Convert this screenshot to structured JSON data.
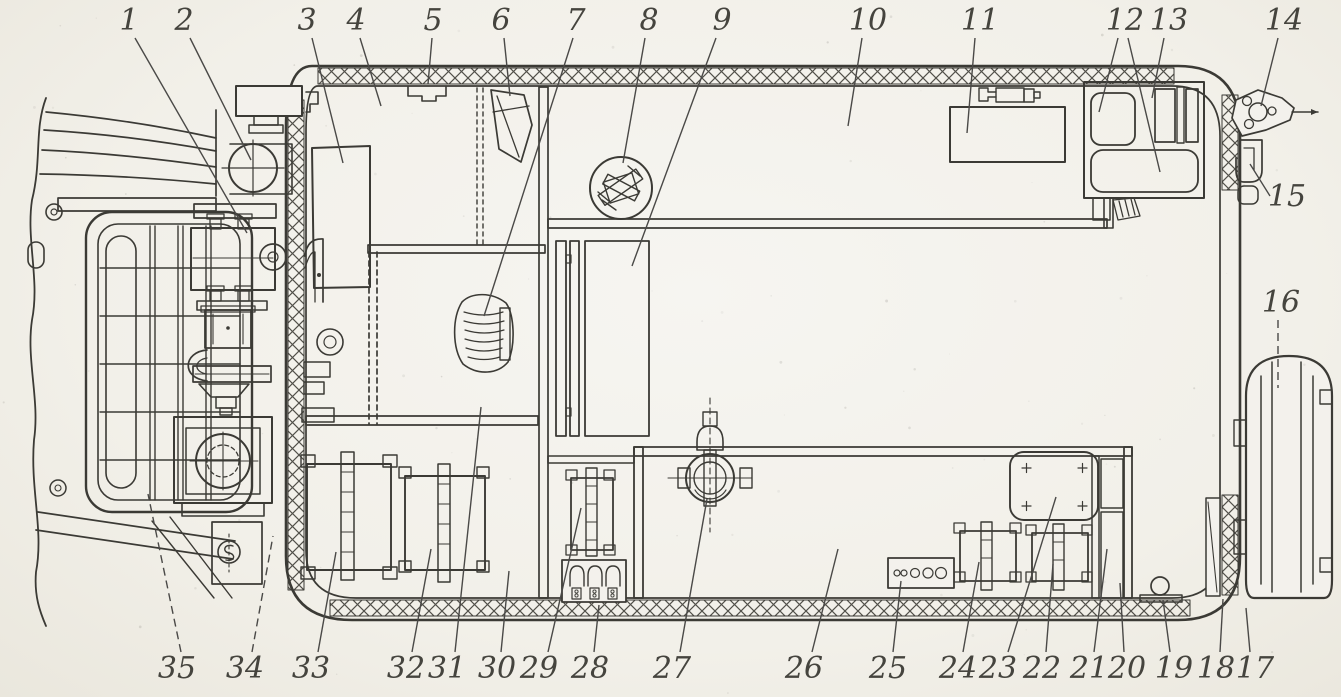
{
  "meta": {
    "type": "scanned technical cutaway diagram",
    "subject": "top-view schematic of vehicle body with numbered equipment layout",
    "numbered_parts_count": 35
  },
  "palette": {
    "paper": "#f3f1ec",
    "ink": "#3b3a35",
    "label_ink": "#45443e"
  },
  "callouts": [
    {
      "n": "1",
      "x": 129,
      "y": 30,
      "leaders": [
        {
          "x1": 135,
          "y1": 38,
          "x2": 247,
          "y2": 233
        }
      ]
    },
    {
      "n": "2",
      "x": 184,
      "y": 30,
      "leaders": [
        {
          "x1": 190,
          "y1": 38,
          "x2": 251,
          "y2": 160
        }
      ]
    },
    {
      "n": "3",
      "x": 307,
      "y": 30,
      "leaders": [
        {
          "x1": 312,
          "y1": 38,
          "x2": 343,
          "y2": 163
        }
      ]
    },
    {
      "n": "4",
      "x": 356,
      "y": 30,
      "leaders": [
        {
          "x1": 360,
          "y1": 38,
          "x2": 381,
          "y2": 106
        }
      ]
    },
    {
      "n": "5",
      "x": 433,
      "y": 30,
      "leaders": [
        {
          "x1": 432,
          "y1": 38,
          "x2": 428,
          "y2": 84
        }
      ]
    },
    {
      "n": "6",
      "x": 501,
      "y": 30,
      "leaders": [
        {
          "x1": 504,
          "y1": 38,
          "x2": 510,
          "y2": 96
        }
      ]
    },
    {
      "n": "7",
      "x": 576,
      "y": 30,
      "leaders": [
        {
          "x1": 573,
          "y1": 38,
          "x2": 484,
          "y2": 316
        }
      ]
    },
    {
      "n": "8",
      "x": 649,
      "y": 30,
      "leaders": [
        {
          "x1": 645,
          "y1": 38,
          "x2": 623,
          "y2": 163
        }
      ]
    },
    {
      "n": "9",
      "x": 722,
      "y": 30,
      "leaders": [
        {
          "x1": 716,
          "y1": 38,
          "x2": 632,
          "y2": 266
        }
      ]
    },
    {
      "n": "10",
      "x": 868,
      "y": 30,
      "leaders": [
        {
          "x1": 862,
          "y1": 38,
          "x2": 848,
          "y2": 126
        }
      ]
    },
    {
      "n": "11",
      "x": 980,
      "y": 30,
      "leaders": [
        {
          "x1": 975,
          "y1": 38,
          "x2": 967,
          "y2": 133
        }
      ]
    },
    {
      "n": "12",
      "x": 1125,
      "y": 30,
      "leaders": [
        {
          "x1": 1118,
          "y1": 38,
          "x2": 1099,
          "y2": 112
        },
        {
          "x1": 1128,
          "y1": 38,
          "x2": 1160,
          "y2": 172
        }
      ]
    },
    {
      "n": "13",
      "x": 1169,
      "y": 30,
      "leaders": [
        {
          "x1": 1164,
          "y1": 38,
          "x2": 1152,
          "y2": 98
        }
      ]
    },
    {
      "n": "14",
      "x": 1284,
      "y": 30,
      "leaders": [
        {
          "x1": 1278,
          "y1": 38,
          "x2": 1261,
          "y2": 106
        }
      ]
    },
    {
      "n": "15",
      "x": 1287,
      "y": 206,
      "leaders": [
        {
          "x1": 1270,
          "y1": 196,
          "x2": 1250,
          "y2": 164
        }
      ]
    },
    {
      "n": "16",
      "x": 1281,
      "y": 312,
      "leaders": [
        {
          "x1": 1278,
          "y1": 320,
          "x2": 1278,
          "y2": 388,
          "dash": true
        }
      ]
    },
    {
      "n": "17",
      "x": 1255,
      "y": 678,
      "leaders": [
        {
          "x1": 1250,
          "y1": 652,
          "x2": 1246,
          "y2": 608
        }
      ]
    },
    {
      "n": "18",
      "x": 1216,
      "y": 678,
      "leaders": [
        {
          "x1": 1220,
          "y1": 652,
          "x2": 1223,
          "y2": 599
        }
      ]
    },
    {
      "n": "19",
      "x": 1174,
      "y": 678,
      "leaders": [
        {
          "x1": 1170,
          "y1": 652,
          "x2": 1163,
          "y2": 600
        }
      ]
    },
    {
      "n": "20",
      "x": 1127,
      "y": 678,
      "leaders": [
        {
          "x1": 1124,
          "y1": 652,
          "x2": 1120,
          "y2": 583
        }
      ]
    },
    {
      "n": "21",
      "x": 1089,
      "y": 678,
      "leaders": [
        {
          "x1": 1094,
          "y1": 652,
          "x2": 1107,
          "y2": 549
        }
      ]
    },
    {
      "n": "22",
      "x": 1042,
      "y": 678,
      "leaders": [
        {
          "x1": 1046,
          "y1": 652,
          "x2": 1053,
          "y2": 564
        }
      ]
    },
    {
      "n": "23",
      "x": 998,
      "y": 678,
      "leaders": [
        {
          "x1": 1008,
          "y1": 652,
          "x2": 1056,
          "y2": 497
        }
      ]
    },
    {
      "n": "24",
      "x": 958,
      "y": 678,
      "leaders": [
        {
          "x1": 963,
          "y1": 652,
          "x2": 979,
          "y2": 562
        }
      ]
    },
    {
      "n": "25",
      "x": 888,
      "y": 678,
      "leaders": [
        {
          "x1": 893,
          "y1": 652,
          "x2": 901,
          "y2": 581
        }
      ]
    },
    {
      "n": "26",
      "x": 804,
      "y": 678,
      "leaders": [
        {
          "x1": 812,
          "y1": 652,
          "x2": 838,
          "y2": 549
        }
      ]
    },
    {
      "n": "27",
      "x": 672,
      "y": 678,
      "leaders": [
        {
          "x1": 680,
          "y1": 652,
          "x2": 707,
          "y2": 499
        }
      ]
    },
    {
      "n": "28",
      "x": 590,
      "y": 678,
      "leaders": [
        {
          "x1": 594,
          "y1": 652,
          "x2": 599,
          "y2": 605
        }
      ]
    },
    {
      "n": "29",
      "x": 539,
      "y": 678,
      "leaders": [
        {
          "x1": 548,
          "y1": 652,
          "x2": 581,
          "y2": 508
        }
      ]
    },
    {
      "n": "30",
      "x": 497,
      "y": 678,
      "leaders": [
        {
          "x1": 501,
          "y1": 652,
          "x2": 509,
          "y2": 571
        }
      ]
    },
    {
      "n": "31",
      "x": 447,
      "y": 678,
      "leaders": [
        {
          "x1": 455,
          "y1": 652,
          "x2": 481,
          "y2": 407
        }
      ]
    },
    {
      "n": "32",
      "x": 406,
      "y": 678,
      "leaders": [
        {
          "x1": 412,
          "y1": 652,
          "x2": 431,
          "y2": 549
        }
      ]
    },
    {
      "n": "33",
      "x": 311,
      "y": 678,
      "leaders": [
        {
          "x1": 318,
          "y1": 652,
          "x2": 336,
          "y2": 552
        }
      ]
    },
    {
      "n": "34",
      "x": 245,
      "y": 678,
      "leaders": [
        {
          "x1": 252,
          "y1": 652,
          "x2": 273,
          "y2": 536,
          "dash": true
        }
      ]
    },
    {
      "n": "35",
      "x": 177,
      "y": 678,
      "leaders": [
        {
          "x1": 181,
          "y1": 652,
          "x2": 148,
          "y2": 494,
          "dash": true
        }
      ]
    }
  ]
}
